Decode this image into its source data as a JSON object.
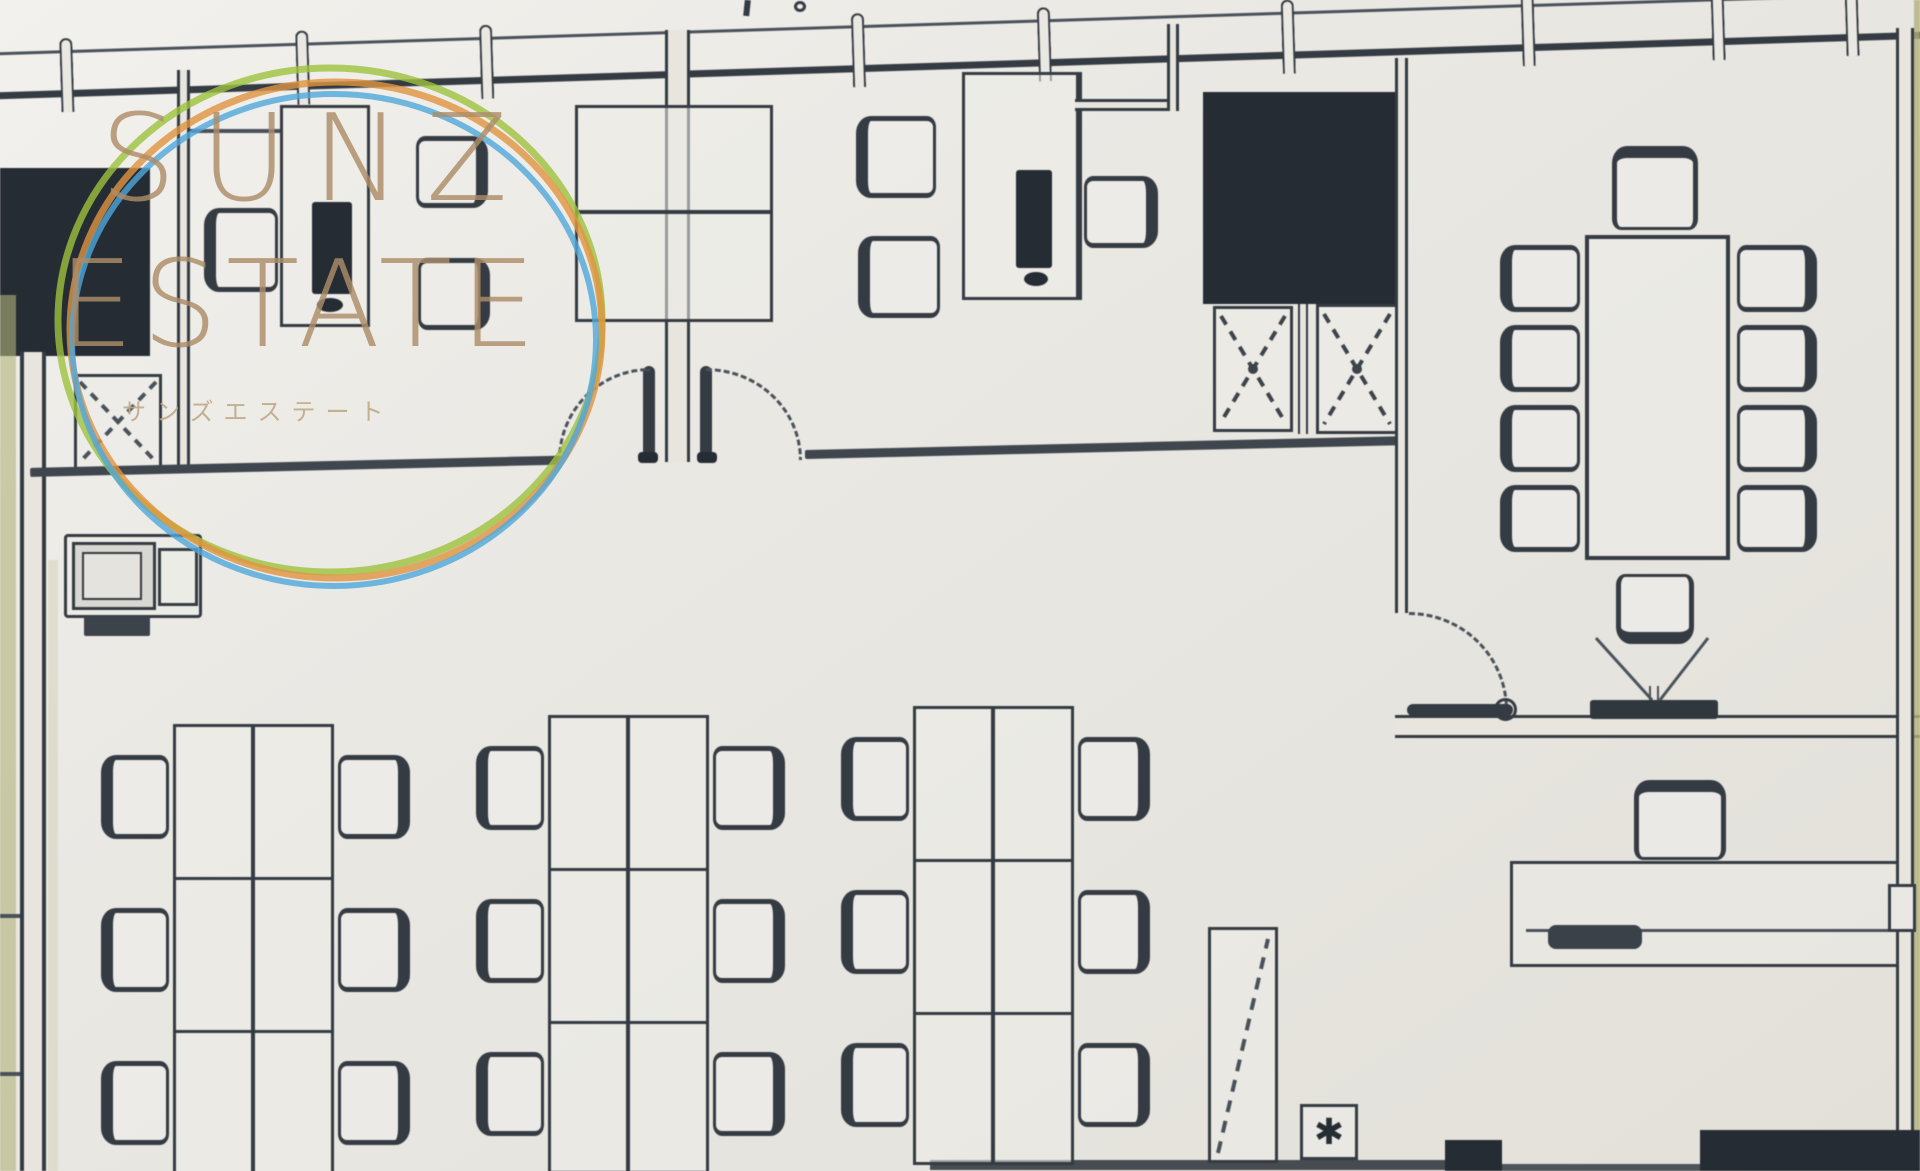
{
  "watermark": {
    "brand_top": "SUNZ",
    "brand_bottom": "ESTATE",
    "brand_kana": "サンズエステート"
  },
  "symbols": {
    "asterisk": "✱"
  },
  "palette": {
    "paper": "#eae8e3",
    "paper_highlight": "#f2f1ed",
    "ink": "#343b42",
    "ink_soft": "#49515a",
    "dark_fill": "#262c34",
    "page_edge_olive": "#b3b27c",
    "wm_ring_green": "#9ec23d",
    "wm_ring_orange": "#e09340",
    "wm_ring_blue": "#4fa8dc",
    "wm_text_tan": "#ac8c68"
  },
  "inventory": {
    "workstation_islands": 3,
    "workstations_per_island": 6,
    "open_office_seats": 18,
    "private_meeting_desks": 2,
    "conference_table_seats": 10,
    "x_marked_storage_units": 2,
    "copier_machines": 1,
    "reception_desks": 1
  }
}
